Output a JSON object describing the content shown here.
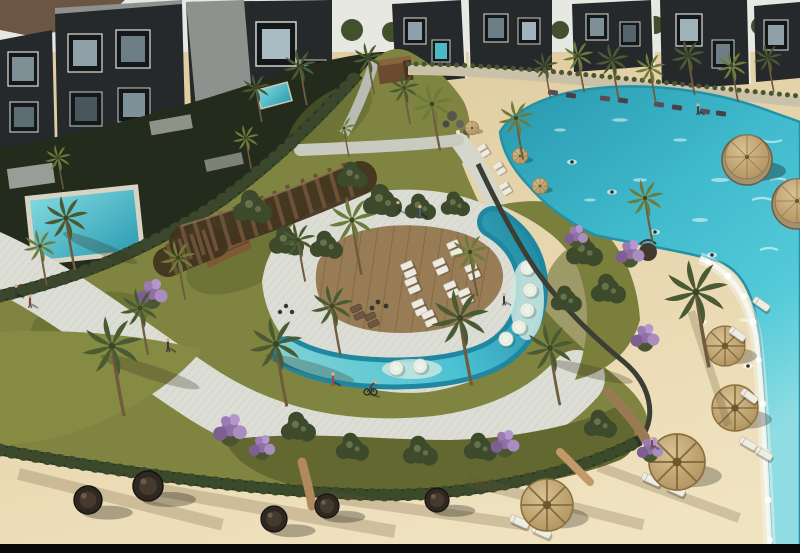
{
  "scene": {
    "type": "aerial-architectural-rendering",
    "subject": "resort residential compound with swimmable lagoon, sun deck, pergola promenade, gardens and sandy beach",
    "lighting": "bright daylight, long diagonal shadows"
  },
  "palette": {
    "sky": "#e8e8e2",
    "hill": "#6a5642",
    "tree_green": "#42502d",
    "palm_green": "#4a5a33",
    "palm_light": "#6d7c3a",
    "building_dark": "#26292b",
    "building_roof": "#8e918d",
    "building_trim": "#e9e9e3",
    "glass_dark": "#49565e",
    "glass_light": "#a9bcc4",
    "courtyard": "#232b1d",
    "hedge": "#28301f",
    "lawn": "#7f8440",
    "lawn_dark": "#62682f",
    "pavement": "#dcded5",
    "pavement_line": "#8f958a",
    "pergola_dark": "#42331f",
    "pergola_wood": "#6b5138",
    "cabin_wood": "#7d5a36",
    "deck_wood": "#977c55",
    "deck_plank": "#6e5639",
    "pool_deep": "#1f87a0",
    "pool_bright": "#4cc2d5",
    "pool_shelf": "#cfe9e2",
    "lagoon_deep": "#2a9ab0",
    "lagoon_mid": "#3fb9cc",
    "lagoon_bright": "#55cbd9",
    "lagoon_pale": "#8fdde2",
    "sand": "#e9d9b2",
    "sand_shadow": "#a98e63",
    "foam": "#f4f7f2",
    "wall_stone": "#c9c2a8",
    "straw": "#d8c193",
    "straw_dark": "#8a6f3e",
    "pod_dark": "#2f2821",
    "lounger_white": "#edeae1",
    "lounger_dark": "#6b5742",
    "flower_purple": "#9a7cb3",
    "skin": "#d9b08c",
    "black_bar": "#0a0a0a"
  },
  "inventory": {
    "buildings": {
      "left_cluster": 4,
      "center_cluster": 2,
      "right_cluster": 3,
      "style": "dark cubic apartments with white-trimmed glazing"
    },
    "private_plunge_pools": 5,
    "lagoon": {
      "cabana_islands": 2,
      "swimmers": 7,
      "rock_feature": 1,
      "shore_umbrellas": 3,
      "shore_lounger_rows": 8
    },
    "sun_deck": {
      "white_lounger_pairs": 9,
      "dark_lounger_pairs": 2
    },
    "crescent_pool_stepping_stones": 7,
    "pergola_walkway_slats": 17,
    "palm_trees": 30,
    "shade_trees": 15,
    "purple_flower_shrubs": 8,
    "beach": {
      "round_day_pods": 5,
      "straw_parasols": 4,
      "sunbed_pairs": 5
    },
    "people": {
      "walkers": 9,
      "cyclists": 1,
      "seated_group": 1
    }
  }
}
